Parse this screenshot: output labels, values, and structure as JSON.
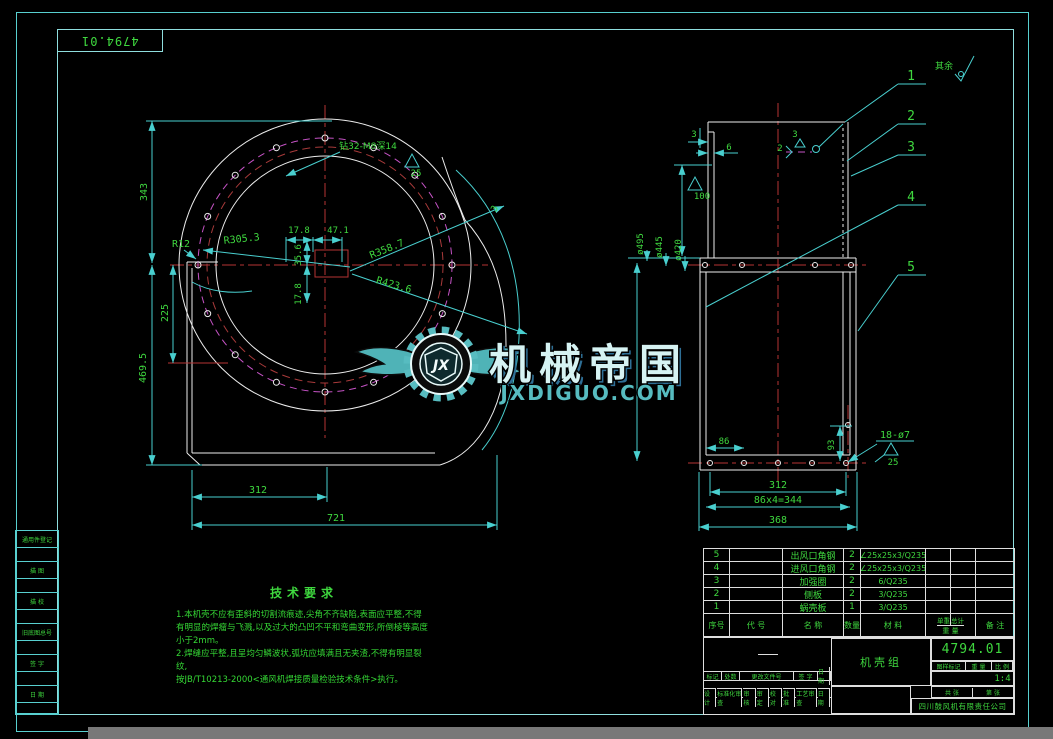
{
  "sheet": {
    "corner_number": "4794.01"
  },
  "general_note": {
    "label": "其余"
  },
  "left_view": {
    "note_thread": "钻32-M8深14",
    "rough_25": "25",
    "dim_343": "343",
    "dim_469": "469.5",
    "dim_225": "225",
    "dim_r12": "R12",
    "dim_r305": "R305.3",
    "dim_17_8_h": "17.8",
    "dim_47_1": "47.1",
    "dim_35_6": "35.6",
    "dim_17_8_v": "17.8",
    "dim_r358": "R358.7",
    "dim_r423": "R423.6",
    "dim_angle": "3",
    "dim_312": "312",
    "dim_721": "721"
  },
  "right_view": {
    "dim_3": "3",
    "dim_6": "6",
    "dim_100": "100",
    "phi495": "ø495",
    "phi445": "ø445",
    "phi420": "ø420",
    "weld_num": "2",
    "weld_size": "3",
    "dim_86": "86",
    "dim_93": "93",
    "dim_312": "312",
    "dim_86x4": "86x4=344",
    "dim_368": "368",
    "holes": "18-ø7",
    "rough": "25",
    "balloons": [
      "1",
      "2",
      "3",
      "4",
      "5"
    ]
  },
  "watermark": {
    "initials": "JX",
    "name": "机械帝国",
    "site": "JXDIGUO.COM"
  },
  "tech": {
    "title": "技术要求",
    "lines": [
      "1.本机壳不应有歪斜的切割流痕迹,尖角不齐缺陷,表面应平整,不得",
      "有明显的焊瘤与飞溅,以及过大的凸凹不平和弯曲变形,所倒棱等高度",
      "小于2mm。",
      "2.焊缝应平整,且呈均匀鳞波状,弧坑应填满且无夹渣,不得有明显裂纹,",
      "按JB/T10213-2000<通风机焊接质量检验技术条件>执行。"
    ]
  },
  "bom": {
    "headers": {
      "no": "序号",
      "code": "代  号",
      "name": "名  称",
      "qty": "数量",
      "material": "材  料",
      "unit": "单重",
      "total": "总计",
      "weight": "重 量",
      "remark": "备  注"
    },
    "rows": [
      {
        "no": "5",
        "code": "",
        "name": "出风口角钢",
        "qty": "2",
        "material": "∠25x25x3/Q235",
        "remark": ""
      },
      {
        "no": "4",
        "code": "",
        "name": "进风口角钢",
        "qty": "2",
        "material": "∠25x25x3/Q235",
        "remark": ""
      },
      {
        "no": "3",
        "code": "",
        "name": "加强圈",
        "qty": "2",
        "material": "6/Q235",
        "remark": ""
      },
      {
        "no": "2",
        "code": "",
        "name": "侧板",
        "qty": "2",
        "material": "3/Q235",
        "remark": ""
      },
      {
        "no": "1",
        "code": "",
        "name": "蜗壳板",
        "qty": "1",
        "material": "3/Q235",
        "remark": ""
      }
    ]
  },
  "title_block": {
    "part_name": "机壳组",
    "drawing_number": "4794.01",
    "mark_label": "图样标记",
    "weight_label": "重 量",
    "scale_label": "比 例",
    "scale": "1:4",
    "sheets_total_label": "共  张",
    "sheet_no_label": "第  张",
    "company": "四川鼓风机有限责任公司",
    "rev": {
      "mark": "标记",
      "count": "处数",
      "doc": "更改文件号",
      "sign": "签 字",
      "date": "日 期"
    },
    "staff": [
      {
        "l": "设 计",
        "r": "标准化审查"
      },
      {
        "l": "审 核",
        "r": "审 定"
      },
      {
        "l": "校 对",
        "r": "批 准"
      },
      {
        "l": "工艺审查",
        "r": "日 期"
      }
    ]
  },
  "margin": {
    "labels": [
      "通用件登记",
      "描 图",
      "描 校",
      "旧底图总号",
      "签 字",
      "日 期"
    ]
  }
}
